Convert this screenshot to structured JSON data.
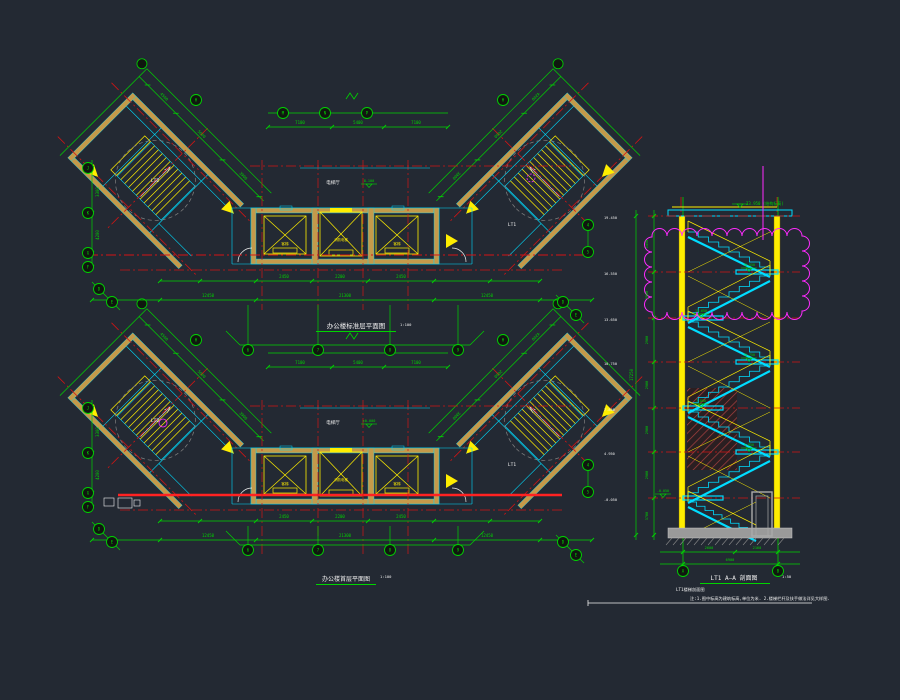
{
  "canvas": {
    "bg": "#232933"
  },
  "colors": {
    "green": "#00d400",
    "red": "#d41414",
    "bright_red": "#ff2222",
    "yellow": "#ffee00",
    "cyan": "#00dcff",
    "tan": "#c49a4a",
    "white": "#f0f0f0",
    "magenta": "#ff2bff",
    "gray": "#9a9a9a"
  },
  "plans": {
    "wing_dims": [
      "4500",
      "5600",
      "3900"
    ],
    "left_dims": [
      "3300",
      "4200"
    ],
    "top": {
      "title": "办公楼标准层平面图",
      "scale": "1:100",
      "lobby_label": "电梯厅",
      "level_mark": "8.100",
      "top_dims": [
        "7100",
        "5400",
        "7100"
      ],
      "core_dims": [
        "2450",
        "2200",
        "2450"
      ],
      "overall_dims": [
        "12450",
        "21300",
        "12450"
      ],
      "left_stair_label": "LT2",
      "right_stair_label": "LT1"
    },
    "bottom": {
      "title": "办公楼首层平面图",
      "scale": "1:100",
      "lobby_label": "电梯厅",
      "level_mark": "±0.000",
      "top_dims": [
        "7100",
        "5400",
        "7100"
      ],
      "core_dims": [
        "2450",
        "2200",
        "2450"
      ],
      "overall_dims": [
        "12450",
        "21300",
        "12450"
      ],
      "left_stair_label": "LT2",
      "right_stair_label": "LT1"
    }
  },
  "core": {
    "elevators": [
      "客梯",
      "消防电梯",
      "客梯"
    ]
  },
  "section": {
    "title": "LT1 A—A 剖面图",
    "scale": "1:50",
    "subtitle": "LT1楼梯剖面图",
    "roof_note": "23.950 (结构标高)",
    "levels": [
      "19.450",
      "16.550",
      "13.650",
      "10.750",
      "7.850",
      "4.950",
      "-0.050"
    ],
    "storey_dims": [
      "1450",
      "2900",
      "2900",
      "2900",
      "2900",
      "2900",
      "3700"
    ],
    "marker_texts": [
      "16.550",
      "13.650",
      "10.750",
      "7.850",
      "4.950",
      "-0.050"
    ],
    "total_height": "17250",
    "bottom_dims": [
      "2600",
      "2160",
      "6900"
    ]
  },
  "bubbles": {
    "labels": [
      "J",
      "K",
      "G",
      "F",
      "H",
      "H",
      "M",
      "N",
      "P",
      "6",
      "7",
      "8",
      "9",
      "D",
      "E",
      "D",
      "E",
      "4",
      "5",
      "J",
      "K",
      "G",
      "F",
      "H",
      "H",
      "6",
      "7",
      "8",
      "9",
      "D",
      "E",
      "D",
      "E",
      "4",
      "5",
      "A",
      "B"
    ]
  },
  "notes": {
    "text": "注:1.图中标高为建筑标高,单位为米.  2.楼梯栏杆及扶手做法详见大样图."
  }
}
